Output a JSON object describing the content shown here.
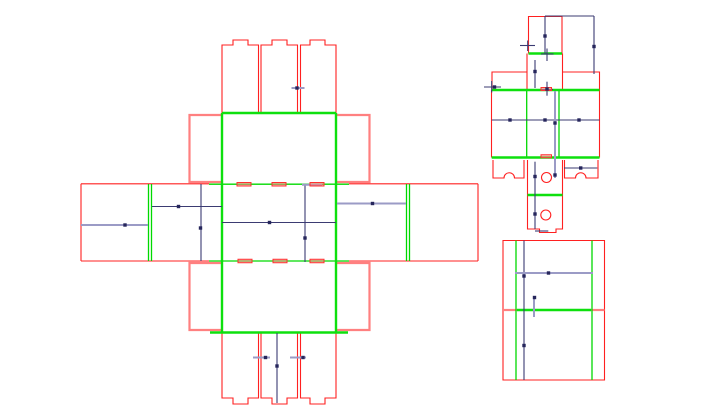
{
  "drawing": {
    "canvas": {
      "width": 720,
      "height": 416,
      "background": "#ffffff"
    },
    "styles": {
      "cut": {
        "stroke": "#ff2020",
        "width": 1.1
      },
      "cutT": {
        "stroke": "#ff8080",
        "width": 2.2
      },
      "fold": {
        "stroke": "#00d900",
        "width": 1.3
      },
      "foldT": {
        "stroke": "#0ee00e",
        "width": 2.4
      },
      "dim": {
        "stroke": "#3b3b72",
        "width": 1.1
      },
      "dimT": {
        "stroke": "#9b9bc6",
        "width": 2.0
      },
      "marker_fill": "#26265c",
      "marker_size": 3.4,
      "slot_stroke": "#ff3030",
      "slot_fill": "rgba(255,130,130,0.55)",
      "circle_stroke": "#ff2020"
    },
    "pieces": [
      {
        "name": "main-cross-dieline",
        "paths": [
          {
            "cls": "cut",
            "d": "M222,113 V45 H233 V40 H248 V45 H258.5 V113"
          },
          {
            "cls": "cut",
            "d": "M261,113 V45 H272 V40 H287 V45 H297.5 V113"
          },
          {
            "cls": "cut",
            "d": "M300.5,113 V45 H310 V40 H325 V45 H336 V113"
          },
          {
            "cls": "cut",
            "d": "M222,333 V398 H233 V404 H248 V398 H258.5 V333"
          },
          {
            "cls": "cut",
            "d": "M261,333 V398 H272 V404 H287 V398 H297.5 V333"
          },
          {
            "cls": "cut",
            "d": "M300.5,333 V398 H310 V404 H325 V398 H336 V333"
          },
          {
            "cls": "cutT",
            "d": "M222,115 H189.5 V182 H222"
          },
          {
            "cls": "cutT",
            "d": "M336,115 H369.5 V182 H336"
          },
          {
            "cls": "cutT",
            "d": "M222,263 H189.5 V330 H222"
          },
          {
            "cls": "cutT",
            "d": "M336,263 H369.5 V330 H336"
          }
        ],
        "segments": {
          "cut": [
            [
              81,
              183.8,
              209,
              183.8
            ],
            [
              349,
              183.8,
              478,
              183.8
            ],
            [
              81,
              261,
              209,
              261
            ],
            [
              349,
              261,
              478,
              261
            ],
            [
              81,
              183.8,
              81,
              261
            ],
            [
              478,
              183.8,
              478,
              261
            ]
          ],
          "fold": [
            [
              209,
              184.2,
              349,
              184.2
            ],
            [
              209,
              261,
              349,
              261
            ],
            [
              148.5,
              184,
              148.5,
              261
            ],
            [
              151.5,
              184,
              151.5,
              261
            ],
            [
              406.5,
              184,
              406.5,
              261
            ],
            [
              409.5,
              184,
              409.5,
              261
            ]
          ],
          "foldT": [
            [
              222,
              113,
              336,
              113
            ],
            [
              210,
              332.5,
              348,
              332.5
            ],
            [
              222,
              113,
              222,
              332.5
            ],
            [
              336,
              113,
              336,
              332.5
            ]
          ],
          "dim": [
            [
              152,
              206.5,
              222,
              206.5
            ],
            [
              201,
              184,
              201,
              261
            ],
            [
              222,
              222.5,
              336,
              222.5
            ],
            [
              305,
              185,
              305,
              262
            ],
            [
              277,
              333,
              277,
              403
            ]
          ],
          "dimT": [
            [
              81,
              225,
              148,
              225
            ],
            [
              337,
              203.5,
              406,
              203.5
            ],
            [
              291.5,
              88,
              304.5,
              88
            ],
            [
              253,
              357.5,
              270,
              357.5
            ],
            [
              290,
              357.5,
              306,
              357.5
            ],
            [
              302,
              184.8,
              322,
              184.8
            ]
          ]
        },
        "slots": [
          [
            237,
            182.5,
            14,
            3.5
          ],
          [
            272,
            182.5,
            14,
            3.5
          ],
          [
            310,
            182.5,
            14,
            3.5
          ],
          [
            238,
            259.3,
            14,
            3.5
          ],
          [
            273,
            259.3,
            14,
            3.5
          ],
          [
            310,
            259.3,
            14,
            3.5
          ]
        ],
        "circles": [],
        "markers": [
          [
            125,
            225
          ],
          [
            178.5,
            206.5
          ],
          [
            200.5,
            228
          ],
          [
            269.5,
            222.5
          ],
          [
            305,
            238
          ],
          [
            372.5,
            203.5
          ],
          [
            297,
            88
          ],
          [
            277,
            366
          ],
          [
            265.5,
            357.5
          ],
          [
            303,
            357.5
          ]
        ]
      },
      {
        "name": "small-cross-dieline",
        "paths": [
          {
            "cls": "cut",
            "d": "M528.5,53.5 V16.5 H562 V53.5"
          },
          {
            "cls": "cut",
            "d": "M526.5,72 H492 V90"
          },
          {
            "cls": "cut",
            "d": "M562.5,72 H599.5 V90"
          },
          {
            "cls": "cut",
            "d": "M493,160 V178 H504 A5.2,5.2 0 0 1 514.5,178 H524 V160"
          },
          {
            "cls": "cut",
            "d": "M564.5,160 V178 H575.5 A5.2,5.2 0 0 1 586,178 H598 V160"
          },
          {
            "cls": "cut",
            "d": "M527.5,195 V229 H539.5 V232.5 H556 V229 H562.5 V195"
          }
        ],
        "segments": {
          "cut": [
            [
              527,
              53.5,
              527,
              90
            ],
            [
              562.5,
              53.5,
              562.5,
              90
            ],
            [
              491.5,
              90,
              491.5,
              157.5
            ],
            [
              599.5,
              90,
              599.5,
              157.5
            ],
            [
              527.5,
              160,
              527.5,
              195
            ],
            [
              562.5,
              160,
              562.5,
              195
            ]
          ],
          "fold": [
            [
              526.7,
              90,
              526.7,
              157.5
            ],
            [
              559,
              90,
              559,
              157.5
            ]
          ],
          "foldT": [
            [
              528.5,
              53.5,
              562,
              53.5
            ],
            [
              491.7,
              90,
              599.5,
              90
            ],
            [
              491.7,
              157.5,
              599.5,
              157.5
            ],
            [
              527.5,
              195,
              562.5,
              195
            ]
          ],
          "dim": [
            [
              545,
              16,
              594,
              16
            ],
            [
              545,
              16,
              545,
              54
            ],
            [
              594,
              16,
              594,
              74
            ],
            [
              520,
              45.5,
              535,
              45.5
            ],
            [
              527.7,
              40.5,
              527.7,
              51
            ],
            [
              541,
              54,
              553.5,
              54
            ],
            [
              547,
              48.5,
              547,
              61
            ],
            [
              535,
              60,
              535,
              88
            ],
            [
              484,
              87,
              501,
              87
            ],
            [
              491.7,
              81,
              491.7,
              92.5
            ],
            [
              541,
              89.5,
              553,
              89.5
            ],
            [
              547,
              81.7,
              547,
              95.7
            ],
            [
              491.7,
              120,
              599.5,
              120
            ],
            [
              564,
              168,
              597.3,
              168
            ],
            [
              535,
              161.7,
              535,
              229
            ],
            [
              535,
              231,
              548.3,
              231
            ]
          ],
          "dimT": [
            [
              555,
              91,
              555,
              178
            ]
          ]
        },
        "slots": [
          [
            541,
            87.5,
            10.5,
            3
          ],
          [
            541,
            154.8,
            10.5,
            3
          ]
        ],
        "circles": [
          [
            546.5,
            177.5,
            5
          ],
          [
            545.8,
            215,
            5
          ]
        ],
        "markers": [
          [
            545,
            36
          ],
          [
            594,
            46.5
          ],
          [
            535,
            71.5
          ],
          [
            494.5,
            87
          ],
          [
            547,
            89
          ],
          [
            510,
            120
          ],
          [
            545,
            120
          ],
          [
            579,
            120
          ],
          [
            555,
            123
          ],
          [
            555,
            175
          ],
          [
            580.7,
            168
          ],
          [
            535,
            176.5
          ],
          [
            535,
            214
          ]
        ]
      },
      {
        "name": "bottom-panel-dieline",
        "paths": [
          {
            "cls": "cut",
            "d": "M503,240.5 H604.5 V380 H503 Z"
          }
        ],
        "segments": {
          "cutT": [
            [
              503,
              310,
              517,
              310
            ],
            [
              591,
              310,
              604.5,
              310
            ]
          ],
          "fold": [
            [
              516,
              240.5,
              516,
              380
            ],
            [
              592,
              240.5,
              592,
              380
            ]
          ],
          "foldT": [
            [
              517,
              310,
              591,
              310
            ]
          ],
          "dim": [
            [
              524,
              240.5,
              524,
              380
            ]
          ],
          "dimT": [
            [
              515,
              273,
              593,
              273
            ],
            [
              534,
              296.5,
              534,
              317
            ]
          ]
        },
        "slots": [],
        "circles": [],
        "markers": [
          [
            524,
            276
          ],
          [
            524,
            345.5
          ],
          [
            548.5,
            273
          ],
          [
            534.5,
            297.5
          ]
        ]
      }
    ]
  }
}
